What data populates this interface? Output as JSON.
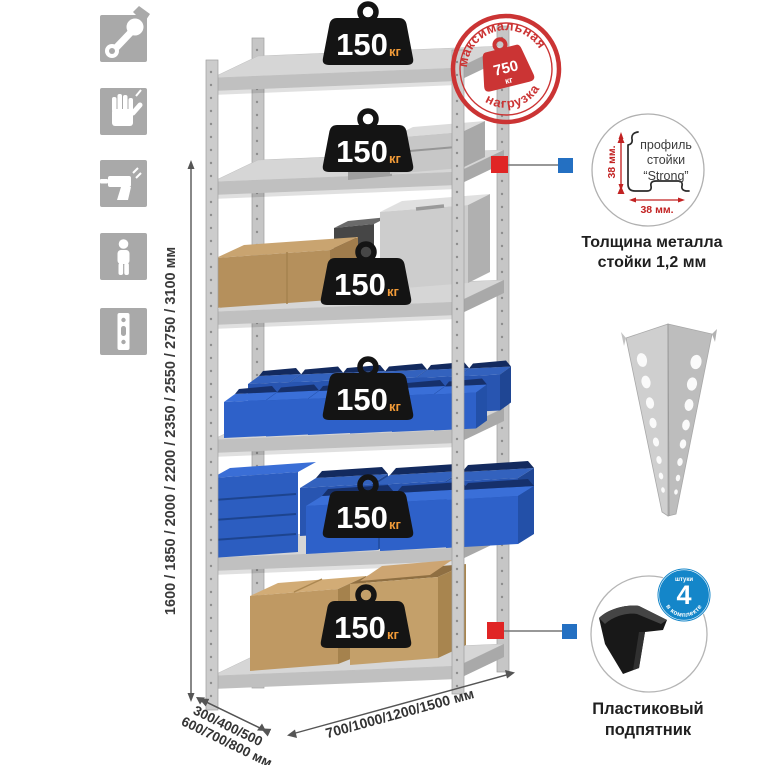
{
  "stamp": {
    "arc_top": "максимальная",
    "arc_bottom": "нагрузка",
    "weight_value": "750",
    "weight_unit": "кг"
  },
  "shelf_load": {
    "value": "150",
    "unit": "кг"
  },
  "height_dimension": {
    "label": "1600 / 1850 / 2000 / 2200 / 2350 / 2550 / 2750 / 3100 мм"
  },
  "depth_dimension": {
    "line1": "300/400/500",
    "line2": "600/700/800 мм"
  },
  "width_dimension": {
    "label": "700/1000/1200/1500 мм"
  },
  "profile_detail": {
    "label_line1": "профиль",
    "label_line2": "стойки",
    "label_line3": "“Strong”",
    "dim_side": "38 мм.",
    "dim_bottom": "38 мм.",
    "caption_line1": "Толщина металла",
    "caption_line2": "стойки 1,2 мм"
  },
  "foot_detail": {
    "badge_value": "4",
    "badge_top": "штуки",
    "badge_arc": "в комплекте",
    "caption_line1": "Пластиковый",
    "caption_line2": "подпятник"
  },
  "side_icons": [
    {
      "name": "wrench-icon"
    },
    {
      "name": "gloves-icon"
    },
    {
      "name": "drill-icon"
    },
    {
      "name": "person-icon"
    },
    {
      "name": "upright-profile-icon"
    }
  ],
  "colors": {
    "stamp_red": "#cb3434",
    "marker_red": "#e02525",
    "marker_blue": "#2470c2",
    "bin_blue": "#2e61c9",
    "badge_black": "#141414",
    "kg_orange": "#f29b38",
    "metal_gray": "#c9c9c9",
    "foot_badge_blue": "#1486c9"
  }
}
